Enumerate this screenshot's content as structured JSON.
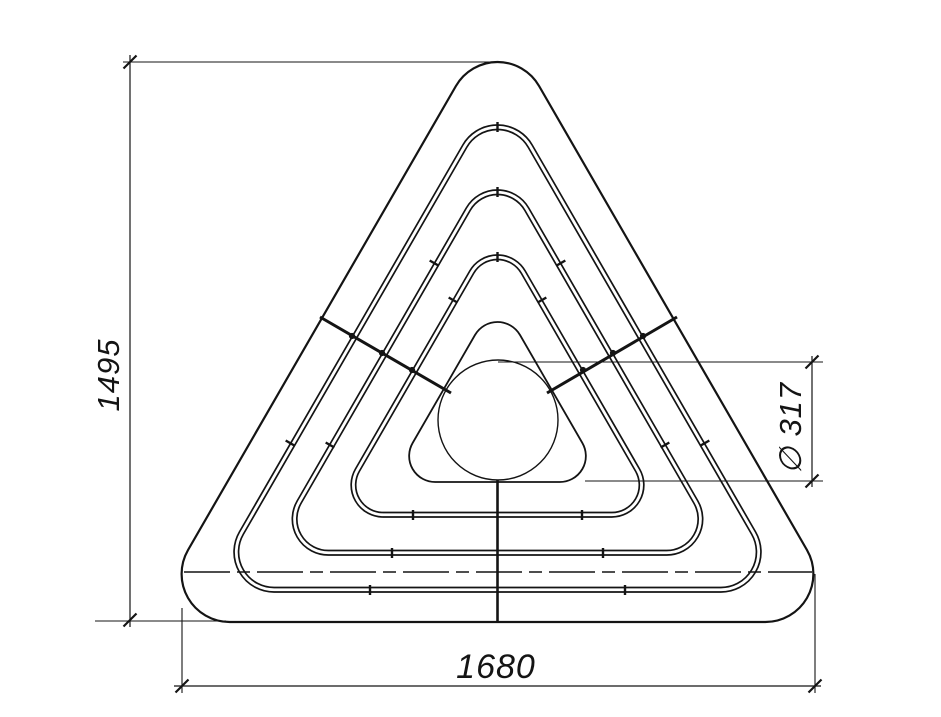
{
  "title": "Triangular bench plan view drawing",
  "drawing": {
    "background": "#ffffff",
    "ink": "#141414",
    "dimensions": {
      "height": {
        "label": "1495"
      },
      "width": {
        "label": "1680"
      },
      "diameter": {
        "label": "∅ 317"
      }
    },
    "figure": {
      "cx": 497.5,
      "rings": [
        {
          "name": "outer-border",
          "style": "single",
          "yTop": 62,
          "yBase": 622,
          "r": 48,
          "width": 2.2
        },
        {
          "name": "plank-ring-1",
          "style": "double",
          "yTop": 125,
          "yBase": 592,
          "r": 40,
          "gap": 4.5,
          "width": 1.7
        },
        {
          "name": "plank-ring-2",
          "style": "double",
          "yTop": 190,
          "yBase": 555,
          "r": 36,
          "gap": 4.5,
          "width": 1.7
        },
        {
          "name": "plank-ring-3",
          "style": "double",
          "yTop": 255,
          "yBase": 517,
          "r": 32,
          "gap": 4.5,
          "width": 1.7
        },
        {
          "name": "inner-border",
          "style": "single",
          "yTop": 322,
          "yBase": 482,
          "r": 26,
          "width": 1.8
        }
      ],
      "circle": {
        "cx": 498,
        "cy": 420,
        "r": 60,
        "width": 1.4
      },
      "joint_ticks": [
        {
          "x": 497.5,
          "y": 127,
          "a": 90
        },
        {
          "x": 497.5,
          "y": 192,
          "a": 90
        },
        {
          "x": 497.5,
          "y": 257,
          "a": 90
        },
        {
          "x": 434,
          "y": 263,
          "a": 30
        },
        {
          "x": 561,
          "y": 263,
          "a": 150
        },
        {
          "x": 453,
          "y": 300,
          "a": 30
        },
        {
          "x": 542,
          "y": 300,
          "a": 150
        },
        {
          "x": 290,
          "y": 443,
          "a": 30
        },
        {
          "x": 705,
          "y": 443,
          "a": 150
        },
        {
          "x": 330,
          "y": 445,
          "a": 30
        },
        {
          "x": 665,
          "y": 445,
          "a": 150
        },
        {
          "x": 413,
          "y": 515,
          "a": 90
        },
        {
          "x": 582,
          "y": 515,
          "a": 90
        },
        {
          "x": 392,
          "y": 553,
          "a": 90
        },
        {
          "x": 603,
          "y": 553,
          "a": 90
        },
        {
          "x": 370,
          "y": 590,
          "a": 90
        },
        {
          "x": 625,
          "y": 590,
          "a": 90
        }
      ],
      "cross_lines": [
        {
          "x1": 320,
          "y1": 317,
          "x2": 451,
          "y2": 393
        },
        {
          "x1": 547,
          "y1": 393,
          "x2": 677,
          "y2": 317
        }
      ],
      "cross_dots": [
        {
          "x": 352,
          "y": 336
        },
        {
          "x": 382,
          "y": 353
        },
        {
          "x": 412,
          "y": 370
        },
        {
          "x": 583,
          "y": 370
        },
        {
          "x": 613,
          "y": 353
        },
        {
          "x": 643,
          "y": 336
        }
      ]
    },
    "construction": {
      "lines": [
        {
          "name": "height-dim-line",
          "x1": 130,
          "y1": 55,
          "x2": 130,
          "y2": 627,
          "w": 1.2
        },
        {
          "name": "height-ext-top",
          "x1": 123,
          "y1": 62,
          "x2": 497,
          "y2": 62,
          "w": 1.1
        },
        {
          "name": "height-ext-bottom",
          "x1": 95,
          "y1": 621,
          "x2": 226,
          "y2": 621,
          "w": 1.1
        },
        {
          "name": "width-dim-line",
          "x1": 174,
          "y1": 686,
          "x2": 821,
          "y2": 686,
          "w": 1.2
        },
        {
          "name": "width-ext-left",
          "x1": 182,
          "y1": 608,
          "x2": 182,
          "y2": 693,
          "w": 1.1
        },
        {
          "name": "width-ext-right",
          "x1": 815,
          "y1": 574,
          "x2": 815,
          "y2": 693,
          "w": 1.1
        },
        {
          "name": "diameter-dim-line",
          "x1": 812,
          "y1": 356,
          "x2": 812,
          "y2": 487,
          "w": 1.2
        },
        {
          "name": "diameter-ext-top",
          "x1": 498,
          "y1": 362,
          "x2": 823,
          "y2": 362,
          "w": 1.1
        },
        {
          "name": "diameter-ext-bottom",
          "x1": 585,
          "y1": 481,
          "x2": 823,
          "y2": 481,
          "w": 1.1
        },
        {
          "name": "centerline-horizontal",
          "x1": 184,
          "y1": 572,
          "x2": 812,
          "y2": 572,
          "w": 1.6,
          "dash": "46 7 13 7"
        },
        {
          "name": "centerline-vertical",
          "x1": 497.5,
          "y1": 480,
          "x2": 497.5,
          "y2": 621,
          "w": 2.6
        }
      ],
      "slash_ticks": [
        {
          "x": 130,
          "y": 62
        },
        {
          "x": 130,
          "y": 620
        },
        {
          "x": 182,
          "y": 686
        },
        {
          "x": 815,
          "y": 686
        },
        {
          "x": 812,
          "y": 362
        },
        {
          "x": 812,
          "y": 481
        }
      ]
    }
  }
}
